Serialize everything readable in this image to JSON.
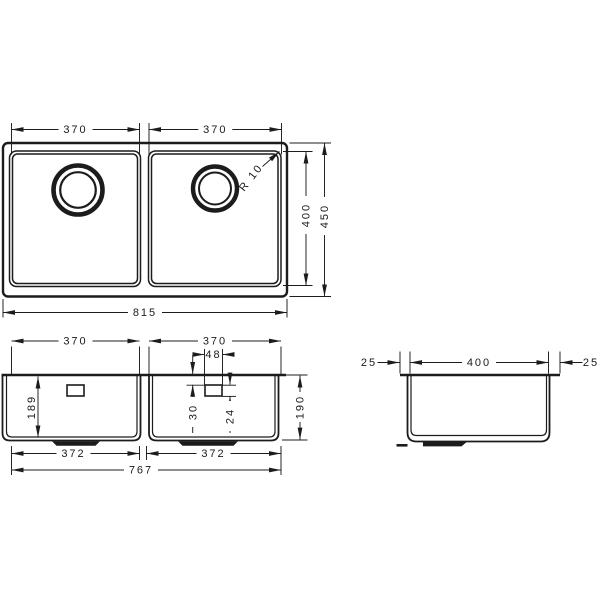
{
  "style": {
    "background": "#ffffff",
    "line_color": "#1c1c1c",
    "text_color": "#1a1a1a"
  },
  "views": {
    "plan": {
      "dims": {
        "bowl_width_left": "370",
        "bowl_width_right": "370",
        "corner_radius": "R 10",
        "bowl_depth": "400",
        "overall_depth": "450",
        "overall_width": "815"
      }
    },
    "front": {
      "dims": {
        "bowl_width_left": "370",
        "bowl_width_right": "370",
        "overflow_width": "48",
        "overflow_offset": "30",
        "overflow_height": "24",
        "depth_inner": "189",
        "depth_outer": "190",
        "bottom_width_left": "372",
        "bottom_width_right": "372",
        "overall_bottom_width": "767"
      }
    },
    "side": {
      "dims": {
        "flange_left": "25",
        "depth": "400",
        "flange_right": "25"
      }
    }
  }
}
